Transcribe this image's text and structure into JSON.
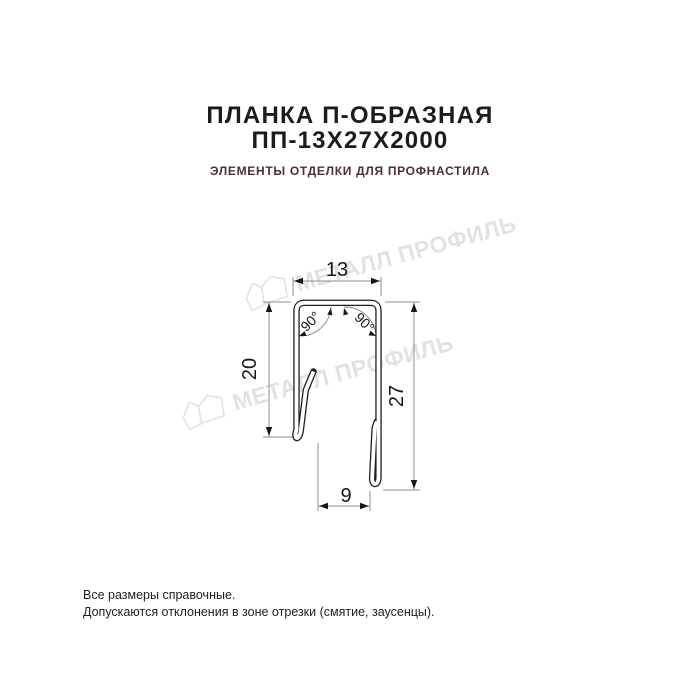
{
  "header": {
    "title_line1": "ПЛАНКА П-ОБРАЗНАЯ",
    "title_line2": "ПП-13Х27Х2000",
    "subtitle": "ЭЛЕМЕНТЫ ОТДЕЛКИ ДЛЯ ПРОФНАСТИЛА"
  },
  "watermark": {
    "brand": "МЕТАЛЛ ПРОФИЛЬ",
    "logo": "metall-profil-crystal-logo"
  },
  "drawing": {
    "description": "U-shaped strip profile cross-section with hemmed edges",
    "dimensions": {
      "top_width": "13",
      "left_height": "20",
      "right_height": "27",
      "bottom_width": "9",
      "angle_left": "90°",
      "angle_right": "90°"
    }
  },
  "footer": {
    "line1": "Все размеры справочные.",
    "line2": "Допускаются отклонения в зоне отрезки (смятие, заусенцы)."
  },
  "colors": {
    "page-bg": "#ffffff",
    "title": "#1c1c1c",
    "subtitle": "#4a3036",
    "watermark": "#e2e2e2",
    "drawing-line": "#1f1f1f",
    "dim-line": "#8f8f8f",
    "dim-text": "#161616",
    "footer": "#1f1f1f"
  }
}
